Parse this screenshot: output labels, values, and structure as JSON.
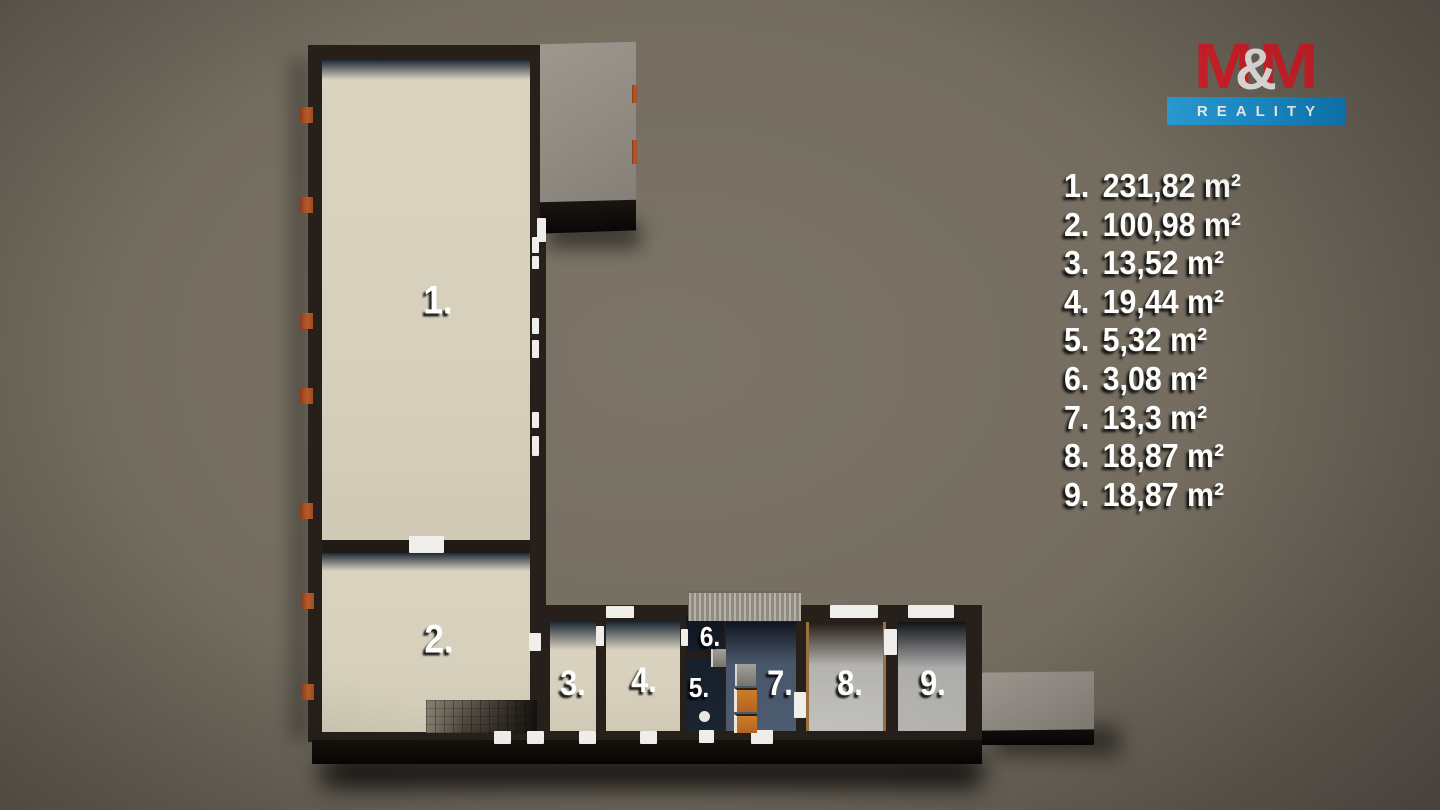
{
  "logo": {
    "m_left": "M",
    "ampersand": "&",
    "m_right": "M",
    "subtitle": "REALITY",
    "red": "#d2202a",
    "blue": "#1b8fcd"
  },
  "legend": {
    "items": [
      {
        "num": "1.",
        "area": "231,82 m²"
      },
      {
        "num": "2.",
        "area": "100,98 m²"
      },
      {
        "num": "3.",
        "area": "13,52 m²"
      },
      {
        "num": "4.",
        "area": "19,44 m²"
      },
      {
        "num": "5.",
        "area": "5,32 m²"
      },
      {
        "num": "6.",
        "area": "3,08 m²"
      },
      {
        "num": "7.",
        "area": "13,3 m²"
      },
      {
        "num": "8.",
        "area": "18,87 m²"
      },
      {
        "num": "9.",
        "area": "18,87 m²"
      }
    ]
  },
  "plan": {
    "room_labels": [
      "1.",
      "2.",
      "3.",
      "4.",
      "5.",
      "6.",
      "7.",
      "8.",
      "9."
    ],
    "colors": {
      "background": "#746d60",
      "wall_dark": "#261f1a",
      "floor_cream": "#d6d0bc",
      "floor_slate_blue": "#4d5b70",
      "floor_navy": "#17202c",
      "floor_gray": "#c2c1bd",
      "roof_gray": "#908b83",
      "window_orange": "#b75a28",
      "wood_trim": "#99703f"
    }
  }
}
